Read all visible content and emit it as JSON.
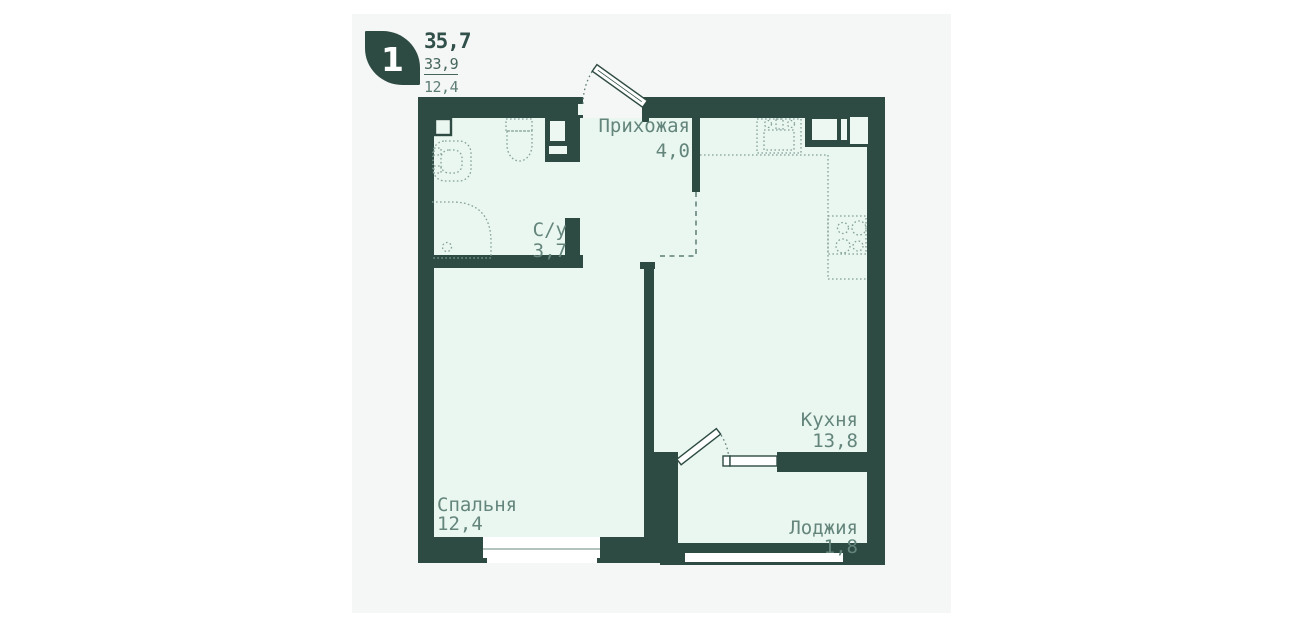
{
  "header": {
    "rooms_count": "1",
    "total_area": "35,7",
    "living_area": "33,9",
    "room_area": "12,4"
  },
  "rooms": [
    {
      "id": "hallway",
      "name": "Прихожая",
      "area": "4,0"
    },
    {
      "id": "bathroom",
      "name": "С/у",
      "area": "3,7"
    },
    {
      "id": "kitchen",
      "name": "Кухня",
      "area": "13,8"
    },
    {
      "id": "bedroom",
      "name": "Спальня",
      "area": "12,4"
    },
    {
      "id": "loggia",
      "name": "Лоджия",
      "area": "1,8"
    }
  ],
  "colors": {
    "wall": "#2e4b43",
    "room_fill": "#e9f7f0",
    "card_background": "#f5f6f6",
    "label_text": "#64857c"
  }
}
